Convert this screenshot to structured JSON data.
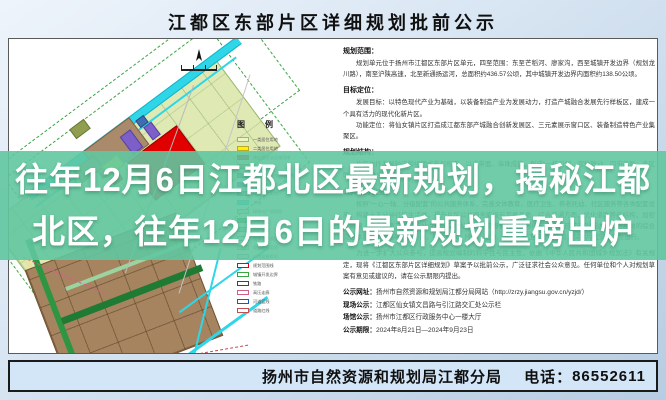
{
  "page": {
    "title": "江都区东部片区详细规划批前公示"
  },
  "overlay": {
    "line1": "往年12月6日江都北区最新规划，揭秘江都",
    "line2": "北区，往年12月6日的最新规划重磅出炉",
    "band_color": "#61c7a0",
    "text_color": "#ffffff"
  },
  "footer": {
    "agency": "扬州市自然资源和规划局江都分局",
    "phone_label": "电话：",
    "phone": "86552611",
    "bar_color": "#d3e6f8"
  },
  "map": {
    "canal_label": "新通扬运河",
    "legend_title": "图　例",
    "colors": {
      "canal": "#2fd6e8",
      "area_base": "#dfe9b4",
      "parcel_red": "#e00000",
      "parcel_brown": "#a98a6b",
      "parcel_purple": "#7c5fc9",
      "parcel_yellow": "#f2e33c",
      "industry_grid": "#a6845f",
      "green_strip": "#2e9643",
      "boundary_dash": "#3aa643"
    },
    "legend_items": [
      {
        "color": "#eef3c3",
        "border": "#9ab86b",
        "label": "一类居住用地"
      },
      {
        "color": "#fff100",
        "border": "#b8a92a",
        "label": "二类居住用地"
      },
      {
        "color": "#e60012",
        "border": "#990000",
        "label": "商业服务业设施用地"
      },
      {
        "color": "#a98a6b",
        "border": "#7d6247",
        "label": "工业用地"
      },
      {
        "color": "#5d79bc",
        "border": "#3c5490",
        "label": "公共管理与公共服务用地"
      },
      {
        "color": "#7c5fc9",
        "border": "#5a41a0",
        "label": "商务设施用地"
      },
      {
        "color": "#8c9db0",
        "border": "#66788c",
        "label": "仓储物流用地"
      },
      {
        "color": "#2fd6e8",
        "border": "#13b4c8",
        "label": "水域"
      },
      {
        "color": "#bfe3bf",
        "border": "#6fae6f",
        "label": "绿地与广场用地"
      },
      {
        "color": "#2e9643",
        "border": "#1f7a33",
        "label": "公园绿地"
      },
      {
        "color": "#9bd4a0",
        "border": "#5f9c66",
        "label": "防护绿地"
      },
      {
        "color": "#ffffff",
        "border": "#888888",
        "label": "道路与交通设施用地"
      },
      {
        "color": "#e8e3a0",
        "border": "#b0a860",
        "label": "交通枢纽用地"
      },
      {
        "color": "#d9d9d9",
        "border": "#999999",
        "label": "公用设施用地"
      },
      {
        "color": "#ffffff",
        "border": "#e60012",
        "label": "规划范围线"
      },
      {
        "color": "#ffffff",
        "border": "#3aa643",
        "label": "城镇开发边界"
      },
      {
        "color": "#ffffff",
        "border": "#444444",
        "label": "铁路"
      },
      {
        "color": "#ffffff",
        "border": "#d0608a",
        "label": "高压走廊"
      },
      {
        "color": "#ffffff",
        "border": "#1a57c0",
        "label": "河道蓝线"
      },
      {
        "color": "#ffffff",
        "border": "#c05050",
        "label": "道路红线"
      }
    ]
  },
  "content": {
    "sections": [
      {
        "heading": "规划范围：",
        "body": "　　规划单元位于扬州市江都区东部片区单元，四至范围：东至芒稻河、廖家沟，西至城镇开发边界（规划龙川路），南至沪陕高速，北至新通扬运河，总面积约436.57公顷，其中城镇开发边界内面积约138.50公顷。"
      },
      {
        "heading": "目标定位：",
        "body": "　　发展目标：以特色现代产业为基础，以装备制造产业为发展动力，打造产城融合发展先行样板区，建成一个具有活力的现代化新片区。\n　　功能定位：将仙女镇片区打造成江都东部产城融合创新发展区、三元素展示窗口区、装备制造特色产业集聚区。"
      },
      {
        "heading": "规划结构：",
        "body": "　　片区依托发展轴带和组团式布局形态，以点带面、串珠成链，形成“一核引领、双轴联动、四带串联、多区联动”的总体空间结构。"
      },
      {
        "heading": "公共服务设施：",
        "body": "　　按照“一心一轴、分级配套”的公共服务体系，完善文体教育、医疗卫生、养老托幼、社区服务等各类配套设施，构建十五分钟社区生活圈，提升片区公共服务能级与宜居品质。综合交通方面，优化道路等级结构，加密支路网，结合轨道交通预留站点与公交场站布局，完善慢行系统与停车设施，形成内外畅达、集约高效的综合交通体系。市政基础设施方面，统筹给水、排水、电力、燃气、环卫等设施布局，保障片区安全韧性运行。"
      }
    ],
    "notice_paragraph": "　　为进一步扩大公众参与，提高规划编制的科学性与民主性，依据《中华人民共和国城乡规划法》有关规定，现将《江都区东部片区详细规划》草案予以批前公示，广泛征求社会公众意见。任何单位和个人对规划草案有意见或建议的，请在公示期限内提出。",
    "publicity": [
      {
        "label": "公示网址：",
        "value": "扬州市自然资源和规划局江都分局网站（http://zrzy.jiangsu.gov.cn/yzjd/）"
      },
      {
        "label": "现场公示：",
        "value": "江都区仙女镇文昌路与引江路交汇处公示栏"
      },
      {
        "label": "场馆公示：",
        "value": "扬州市江都区行政服务中心一楼大厅"
      },
      {
        "label": "公示期限：",
        "value": "2024年8月21日—2024年9月23日"
      }
    ]
  }
}
